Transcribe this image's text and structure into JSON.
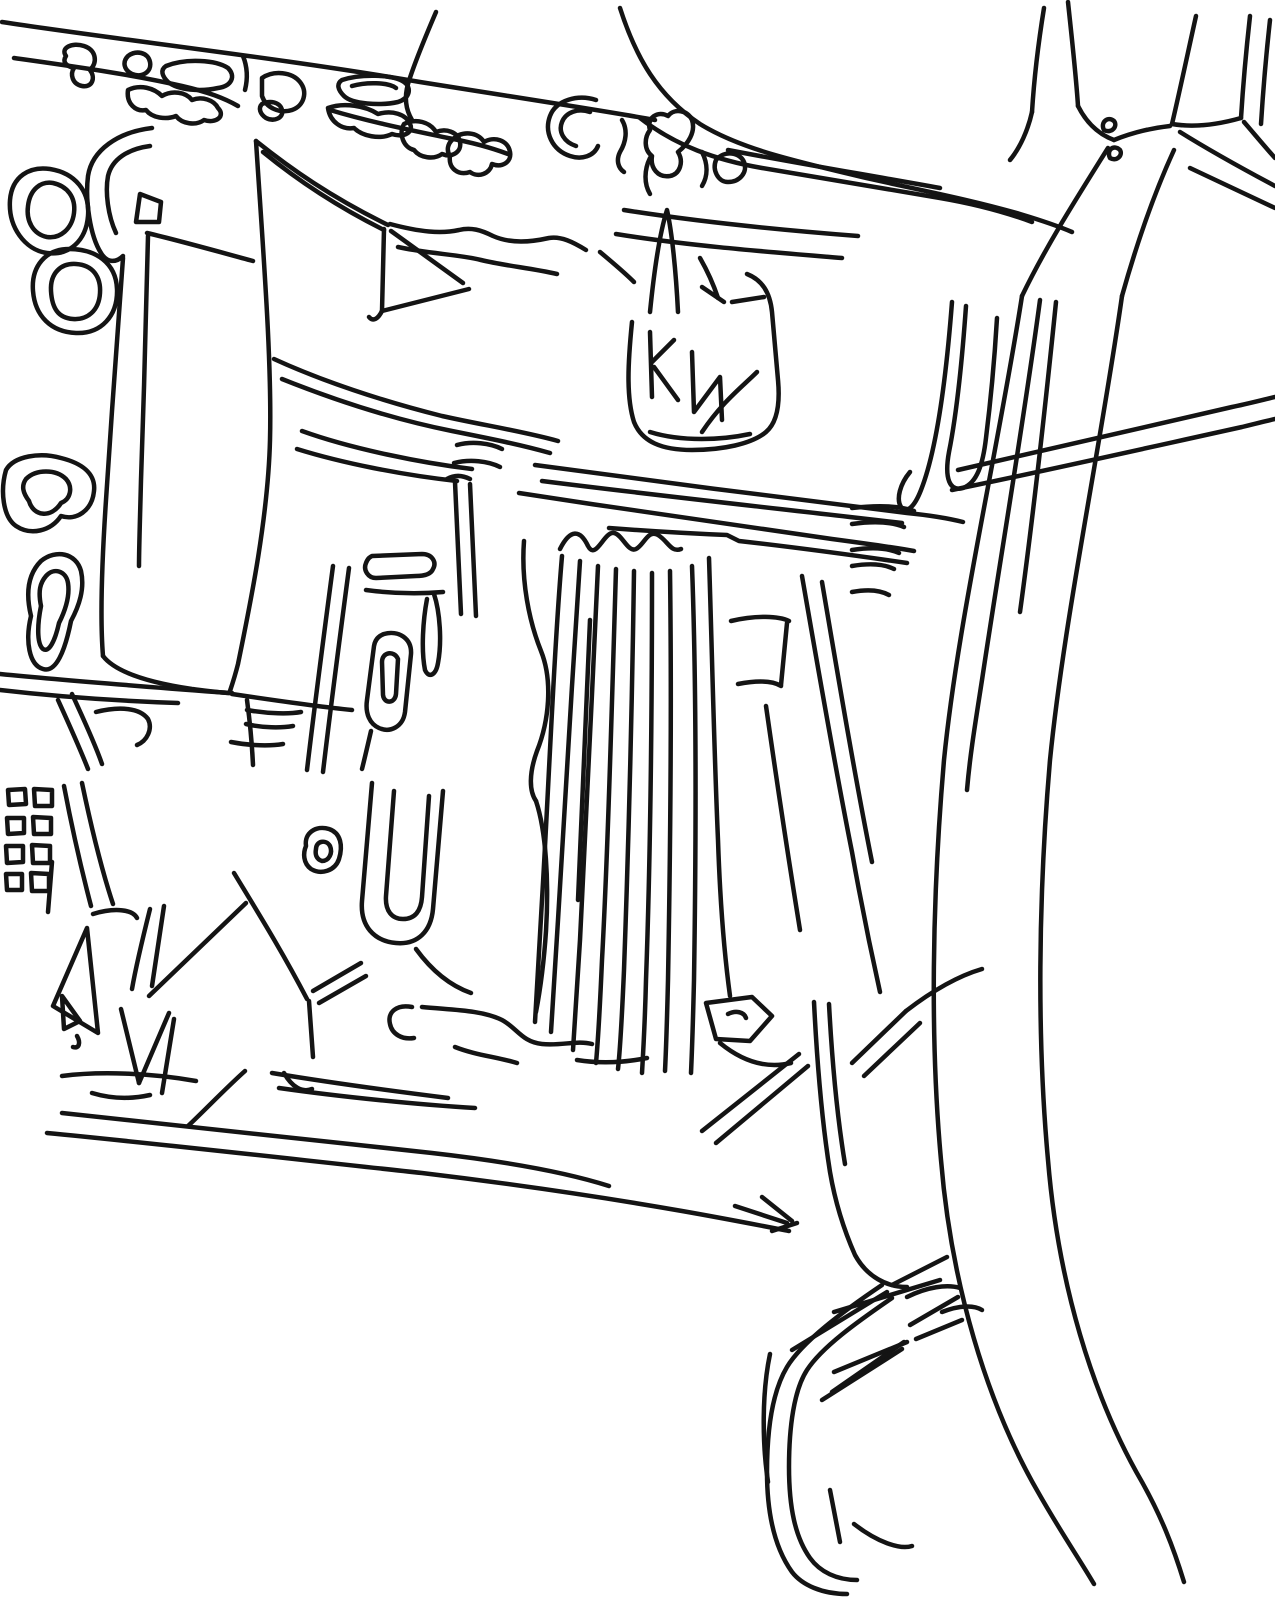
{
  "meta": {
    "canvas": {
      "width": 1275,
      "height": 1600
    },
    "ink_color": "#141414",
    "background_color": "#ffffff",
    "stroke_width": 4.5
  },
  "drawing": {
    "type": "line-drawing",
    "regions": [
      {
        "name": "top-strip-road",
        "strokes": [
          "M2,22 C120,40 280,58 420,82 C520,98 600,110 655,120",
          "M14,58 C70,66 130,74 182,86 C208,92 224,98 238,106",
          "M330,110 C370,122 410,130 448,138 C470,142 492,148 508,154",
          "M436,12 C424,40 414,64 408,84 C404,98 406,110 412,120"
        ]
      },
      {
        "name": "top-strip-vegetation",
        "strokes": [
          "M66,56 C60,48 72,42 84,46 C96,50 98,62 90,70 C96,78 92,88 82,86 C72,84 70,74 74,68 C66,66 62,62 66,56 Z",
          "M128,56 C136,50 148,52 150,62 C152,72 142,78 132,74 C124,70 122,62 128,56 Z",
          "M166,66 C186,58 216,60 228,68 C236,76 232,86 218,88 C200,92 178,90 168,82 C162,76 160,70 166,66 Z",
          "M243,56 C247,66 248,78 245,90",
          "M128,90 C140,84 154,88 162,96 C172,90 186,92 192,100 C202,96 214,100 218,108 C226,116 216,124 204,120 C196,126 182,124 176,116 C166,120 152,118 146,110 C136,112 126,104 128,90 Z",
          "M262,78 C274,70 292,72 300,82 C308,92 304,106 292,110 C280,114 266,108 262,96 Z",
          "M262,104 C270,100 280,102 282,110 C284,118 274,122 266,118 C260,114 258,108 262,104 Z",
          "M342,80 C360,74 392,74 404,82 C412,88 410,98 398,102 C380,106 352,104 344,96 C338,90 336,84 342,80 Z",
          "M352,86 C366,82 388,82 396,88",
          "M328,108 C344,102 366,106 378,114 C392,110 406,114 410,124 C414,132 404,138 392,134 C380,140 362,136 354,128 C342,130 330,122 328,108 Z",
          "M404,124 C416,118 430,122 436,132 C446,128 458,132 460,142 C462,152 452,158 442,154 C434,160 420,158 414,150 C404,148 398,134 404,124 Z",
          "M452,140 C462,130 478,132 484,142 C494,136 508,140 510,152 C512,162 502,168 492,164 C490,174 478,178 470,172 C458,176 448,168 450,156 C446,150 448,144 452,140 Z",
          "M596,100 C578,94 556,100 550,116 C544,132 552,150 570,156 C582,160 594,156 598,146",
          "M590,112 C578,108 566,112 562,122 C558,132 564,142 576,146",
          "M622,120 C628,130 626,142 620,152 C616,160 618,168 624,172",
          "M650,130 C646,118 658,110 668,116 C674,108 688,110 692,120 C696,132 688,144 678,152 C684,162 680,174 670,176 C658,178 650,168 652,156 C644,150 644,138 650,130 Z",
          "M650,158 C644,170 644,184 650,194",
          "M702,152 C708,164 708,176 702,186",
          "M716,160 C724,150 740,152 744,162 C748,172 740,182 728,182 C718,182 712,170 716,160 Z"
        ]
      },
      {
        "name": "top-center-sweeping-road",
        "strokes": [
          "M620,8 C636,58 658,96 700,124 C742,150 800,162 866,178 C920,190 972,200 1020,214 C1040,220 1058,226 1072,232",
          "M640,118 C676,146 716,160 762,168 C820,178 880,188 940,198 C975,204 1005,212 1032,222",
          "M728,150 C790,162 862,174 940,188",
          "M624,210 C700,222 780,230 858,236",
          "M616,234 C690,246 770,252 842,258"
        ]
      },
      {
        "name": "top-right-fork",
        "strokes": [
          "M1044,8 C1038,45 1034,80 1032,112",
          "M1068,2 C1072,40 1076,75 1078,106",
          "M1032,112 C1028,130 1020,148 1010,160",
          "M1078,106 C1086,122 1098,134 1114,140",
          "M1196,16 C1188,52 1180,90 1172,124",
          "M1250,16 C1246,52 1243,86 1241,118",
          "M1270,20 C1266,56 1263,92 1261,124",
          "M1114,140 C1134,132 1152,128 1170,126",
          "M1172,124 C1196,128 1220,124 1241,118",
          "M1104,130 C1100,122 1108,116 1114,121 C1118,126 1112,134 1104,130 Z",
          "M1110,158 C1106,150 1114,144 1120,150 C1123,155 1117,162 1110,158 Z",
          "M1244,122 C1256,136 1266,148 1275,158",
          "M1180,132 C1212,152 1245,170 1275,186",
          "M1190,168 C1220,182 1250,196 1275,208",
          "M1108,148 C1078,196 1046,246 1022,296",
          "M1174,150 C1152,198 1136,246 1122,296"
        ]
      },
      {
        "name": "right-highway",
        "strokes": [
          "M1022,296 C998,450 958,620 944,760 C932,900 930,1040 941,1160 C951,1282 986,1402 1038,1492 C1060,1531 1080,1560 1094,1584",
          "M1122,296 C1100,450 1064,620 1050,760 C1038,900 1037,1040 1048,1160 C1058,1282 1092,1396 1142,1482 C1161,1516 1173,1546 1184,1582",
          "M1040,300 C1024,420 1000,560 982,680 C975,725 970,755 967,790",
          "M1056,302 C1046,400 1034,510 1020,612"
        ]
      },
      {
        "name": "right-mid-roads",
        "strokes": [
          "M958,470 C1040,452 1140,428 1232,407 C1247,404 1262,400 1275,397",
          "M952,490 C1040,472 1142,449 1242,427 C1254,424 1266,421 1275,419"
        ]
      },
      {
        "name": "right-wiggle-verticals",
        "strokes": [
          "M952,302 C946,380 936,452 921,490 C914,508 906,514 901,507 C896,499 900,484 910,472",
          "M966,306 C962,362 957,412 949,452 C944,479 950,492 963,488 C977,483 983,464 986,438 C991,398 995,352 997,318"
        ]
      },
      {
        "name": "right-sidings-upper",
        "strokes": [
          "M852,508 C878,505 900,506 914,511",
          "M852,524 C874,521 892,522 904,527",
          "M852,550 C872,547 888,548 899,553",
          "M852,566 C870,563 884,564 894,569",
          "M852,592 C868,589 880,590 889,595"
        ]
      },
      {
        "name": "upper-left-hook-and-wedge",
        "strokes": [
          "M152,128 C118,132 92,150 88,176 C85,200 90,236 101,253 C107,263 116,263 123,256",
          "M150,146 C128,149 112,159 108,176 C105,192 108,216 116,233",
          "M136,222 L140,194 L161,202 L159,222 Z",
          "M147,233 C181,241 216,251 253,261",
          "M256,141 C263,250 272,360 270,440 C268,520 249,610 238,664 C235,676 232,685 230,691",
          "M256,141 C291,169 331,197 388,225",
          "M263,152 C296,179 336,206 384,230",
          "M390,224 C420,232 441,234 459,230 C471,227 481,230 493,236 C511,244 531,242 549,238 C561,236 573,242 586,250",
          "M398,247 C430,254 456,254 481,260 C506,266 531,268 557,274",
          "M384,229 L382,311",
          "M382,311 C378,319 373,322 369,317",
          "M382,311 L469,289",
          "M391,231 L463,283"
        ]
      },
      {
        "name": "left-double-rings",
        "strokes": [
          "M10,200 C12,176 30,166 50,169 C75,173 90,191 88,216 C86,241 69,256 47,253 C25,250 8,227 10,200 Z",
          "M28,206 C30,189 41,181 53,183 C67,186 76,197 74,213 C72,229 60,239 47,237 C33,234 26,221 28,206 Z",
          "M33,291 C31,266 46,249 69,249 C96,249 116,263 117,289 C118,316 101,334 76,333 C51,332 35,316 33,291 Z",
          "M51,291 C50,273 61,263 76,264 C93,265 101,277 100,293 C99,311 87,320 73,319 C58,318 52,308 51,291 Z"
        ]
      },
      {
        "name": "left-field-block",
        "strokes": [
          "M123,258 C118,330 111,420 106,500 C102,560 100,620 103,656",
          "M148,236 C146,310 144,400 141,480 C140,520 139,548 139,566",
          "M103,656 C116,673 152,683 192,689 C208,691 222,693 232,693",
          "M0,674 C70,681 150,687 229,693",
          "M0,690 C60,697 120,701 178,703",
          "M247,700 C250,722 252,744 253,765",
          "M247,710 C269,714 290,714 301,712",
          "M246,724 C263,728 281,728 293,726",
          "M231,742 C251,746 271,746 283,744",
          "M232,694 C272,700 312,706 352,710"
        ]
      },
      {
        "name": "left-tree-blobs",
        "strokes": [
          "M6,470 C14,456 40,452 61,458 C81,463 96,473 94,491 C92,511 76,521 61,516 C51,531 31,536 16,526 C3,517 0,491 6,470 Z",
          "M26,479 C36,469 56,469 66,479 C73,487 71,499 61,503 C51,519 33,516 29,501 C23,493 21,486 26,479 Z",
          "M41,561 C56,549 76,553 81,571 C85,589 79,606 71,621 C65,651 56,673 43,669 C29,665 25,641 31,616 C25,591 29,573 41,561 Z",
          "M46,576 C54,567 66,571 68,583 C70,596 65,611 59,623 C55,641 49,653 43,649 C37,644 37,626 41,606 C38,591 40,583 46,576 Z",
          "M58,700 C68,722 79,746 88,769",
          "M72,694 C82,716 94,741 102,764",
          "M96,712 C120,706 140,708 148,719 C153,729 147,741 137,745"
        ]
      },
      {
        "name": "center-left-structures",
        "strokes": [
          "M372,556 L422,554 C432,554 437,562 433,569 C431,574 424,576 416,576 L376,578 C368,578 363,570 366,563 C368,558 370,557 372,556 Z",
          "M366,590 C396,594 420,594 443,592",
          "M434,594 C440,612 442,642 438,663 C436,675 429,679 425,670 C421,650 423,620 427,599",
          "M333,566 C324,634 315,702 307,770",
          "M349,568 C340,636 331,704 323,772",
          "M384,634 C398,630 412,638 411,654 L405,712 C403,727 390,733 379,728 C370,724 365,714 367,700 L374,646 C375,640 378,636 384,634 Z",
          "M382,662 C382,652 394,650 398,659 L396,694 C395,704 384,704 383,695 Z",
          "M371,731 C368,744 365,757 362,769",
          "M306,846 C304,833 316,825 329,829 C341,833 343,846 339,859 C335,871 321,875 311,869 C303,863 303,853 306,846 Z",
          "M316,849 C316,841 326,839 330,846 C333,853 329,861 322,861 C316,859 315,854 316,849 Z",
          "M372,783 L362,901 C360,926 374,941 396,943 C418,945 431,931 433,909 L443,791",
          "M394,791 L386,896 C385,911 392,919 403,919 C415,919 421,911 422,897 L429,796",
          "M416,949 C432,971 451,986 471,993"
        ]
      },
      {
        "name": "center-road-band",
        "strokes": [
          "M274,359 C322,381 382,401 442,416 C482,425 522,431 558,441",
          "M282,379 C332,399 392,419 452,431 C492,439 522,445 550,453",
          "M302,431 C352,449 422,463 472,469",
          "M297,449 C342,463 402,475 457,481",
          "M535,465 C652,481 792,499 907,513 C927,515 947,518 963,522",
          "M542,481 C652,495 782,509 902,523",
          "M519,493 C622,509 722,523 832,539 C862,543 892,547 914,551",
          "M609,528 C662,532 702,534 727,535 L739,541 C792,547 852,555 907,563",
          "M457,445 C472,441 490,443 502,449",
          "M454,463 C470,459 488,461 500,467",
          "M447,479 C454,475 462,475 470,479",
          "M455,482 C457,526 459,570 461,614",
          "M470,484 C472,528 474,572 476,616"
        ]
      },
      {
        "name": "building-cluster",
        "strokes": [
          "M632,322 C628,362 626,397 634,422 C642,442 662,450 692,450 C722,450 752,444 766,432 C778,422 780,402 778,380 L772,312 C770,292 762,280 747,274",
          "M650,312 C654,272 660,232 667,210 C672,232 676,272 678,312",
          "M600,252 C612,262 624,272 634,282",
          "M700,258 C708,272 714,286 718,298",
          "M650,332 L652,397",
          "M652,362 L674,340",
          "M654,367 L678,400",
          "M692,352 L694,412 L720,377 L722,420",
          "M702,432 C722,402 742,387 757,372",
          "M732,302 L764,297",
          "M702,287 L724,302",
          "M650,432 C682,442 722,440 750,434"
        ]
      },
      {
        "name": "rail-fan",
        "strokes": [
          "M560,549 C570,529 580,529 588,546 C596,561 604,531 614,533 C622,534 628,553 636,549 C644,545 648,529 658,535 C668,541 671,553 681,549",
          "M524,541 C521,581 529,621 541,651 C553,681 549,721 537,751 C529,773 529,791 536,801",
          "M536,801 C546,831 549,881 546,931 C544,961 540,991 536,1012",
          "M562,556 C554,650 548,800 542,900 C539,950 537,992 535,1022",
          "M580,561 C572,680 564,820 558,920 C555,966 553,1002 551,1032",
          "M598,566 C592,690 586,830 580,940 C577,986 575,1022 573,1050",
          "M616,569 C612,700 608,850 602,960 C600,1006 598,1041 596,1063",
          "M634,571 C632,710 628,860 624,970 C622,1016 620,1051 618,1069",
          "M652,573 C652,720 650,870 646,980 C645,1021 643,1056 642,1073",
          "M670,571 C672,720 670,870 668,980 C667,1021 666,1051 665,1071",
          "M692,566 C697,700 696,850 694,980 C693,1021 692,1051 691,1073",
          "M590,620 C586,720 582,820 578,900"
        ]
      },
      {
        "name": "east-yard-block",
        "strokes": [
          "M709,558 C712,650 714,750 718,840 C720,900 724,952 730,996",
          "M802,576 C817,662 834,762 852,852 C860,897 870,947 880,992",
          "M822,582 C837,670 854,772 872,862",
          "M766,706 C776,776 788,856 800,930",
          "M731,621 C756,615 779,616 789,621",
          "M738,684 C759,680 773,681 781,686",
          "M787,623 L781,685"
        ]
      },
      {
        "name": "yard-bottom-splays",
        "strokes": [
          "M706,1003 L752,997 L772,1016 L750,1041 L716,1039 Z",
          "M728,1014 C736,1010 744,1012 746,1018",
          "M852,1063 L906,1011",
          "M864,1076 L920,1023",
          "M906,1011 C932,991 958,976 982,969",
          "M720,1043 C742,1061 766,1069 791,1063"
        ]
      },
      {
        "name": "small-buildings-grid",
        "strokes": [
          "M8,790 L25,789 L26,804 L9,805 Z",
          "M34,789 L52,790 L52,806 L35,806 Z",
          "M7,818 L24,818 L24,833 L8,834 Z",
          "M33,817 L51,818 L51,834 L34,834 Z",
          "M6,846 L23,846 L23,862 L7,863 Z",
          "M32,845 L50,846 L50,863 L33,863 Z",
          "M6,874 L22,874 L22,890 L7,890 Z",
          "M31,873 L49,874 L49,891 L32,891 Z",
          "M64,786 C72,828 81,868 91,906",
          "M82,783 C91,826 101,868 113,904"
        ]
      },
      {
        "name": "bottom-left-zigzags",
        "strokes": [
          "M93,914 C116,907 133,910 137,918",
          "M87,928 L53,1006 L98,1033 Z",
          "M62,996 L80,1021 L64,1029 Z",
          "M77,1036 C81,1043 79,1049 73,1047",
          "M150,909 C142,941 136,966 132,989",
          "M164,906 L152,986",
          "M121,1009 L139,1083",
          "M139,1083 L169,1013",
          "M174,1019 L162,1093",
          "M149,996 L246,903",
          "M234,873 C257,911 282,951 307,999",
          "M309,1001 L313,1057",
          "M284,1073 C292,1087 302,1093 312,1089",
          "M313,991 L361,963",
          "M319,1003 L366,976",
          "M52,862 L48,912",
          "M62,1076 C100,1071 150,1073 196,1081",
          "M92,1093 C112,1099 132,1099 150,1095"
        ]
      },
      {
        "name": "bottom-long-roads",
        "strokes": [
          "M62,1113 C162,1123 302,1139 432,1153 C502,1161 562,1171 609,1186",
          "M47,1133 C152,1143 292,1159 422,1173 C522,1185 602,1197 682,1211 C722,1218 758,1225 789,1231",
          "M272,1073 C332,1083 392,1091 448,1098",
          "M279,1088 C342,1097 422,1105 475,1108",
          "M188,1126 C208,1107 226,1088 245,1071",
          "M735,1206 L787,1223",
          "M762,1197 L792,1221",
          "M772,1231 L797,1223",
          "M702,1131 L799,1054",
          "M716,1143 L808,1066",
          "M814,1002 C817,1062 822,1122 830,1172 C836,1207 847,1237 855,1255 C867,1277 887,1287 907,1287",
          "M829,1004 C832,1060 837,1116 845,1164"
        ]
      },
      {
        "name": "bottom-center-misc",
        "strokes": [
          "M412,1007 C397,1004 387,1012 390,1024 C392,1034 402,1040 414,1038",
          "M422,1007 C452,1010 482,1010 502,1020 C517,1028 522,1042 542,1044 C562,1046 577,1040 592,1044",
          "M577,1060 C602,1064 627,1062 647,1058",
          "M455,1047 C475,1055 497,1057 517,1063"
        ]
      },
      {
        "name": "bottom-right-loop",
        "strokes": [
          "M882,1285 C842,1312 802,1342 787,1367 C772,1392 767,1432 767,1472 C767,1512 774,1547 792,1572 C802,1585 822,1594 847,1594",
          "M892,1298 C857,1322 822,1347 807,1370 C794,1390 789,1427 789,1467 C789,1507 795,1537 810,1558 C820,1572 837,1580 857,1580",
          "M792,1350 L887,1292",
          "M822,1400 L902,1349",
          "M832,1392 L904,1342",
          "M907,1297 C927,1287 947,1284 960,1288",
          "M942,1312 C960,1305 974,1305 982,1310",
          "M830,1490 L840,1542",
          "M854,1524 C877,1542 900,1550 912,1546",
          "M770,1354 C762,1392 762,1442 768,1482"
        ]
      },
      {
        "name": "bottom-right-sidings",
        "strokes": [
          "M892,1285 L947,1257",
          "M834,1312 L940,1280",
          "M910,1325 L958,1297",
          "M916,1339 L962,1320",
          "M834,1372 L907,1342"
        ]
      }
    ]
  }
}
